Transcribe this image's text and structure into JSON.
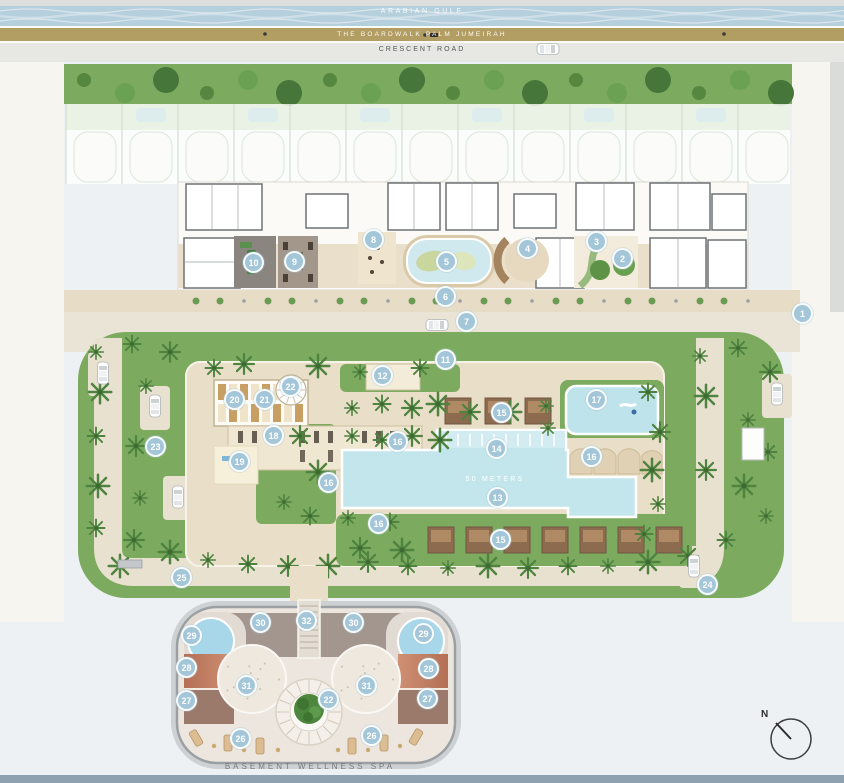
{
  "bands": {
    "top_water_label": "ARABIAN GULF",
    "boardwalk_label": "THE BOARDWALK PALM JUMEIRAH",
    "road_label": "CRESCENT ROAD"
  },
  "plan": {
    "pool_length_label": "50 METERS",
    "spa_label": "BASEMENT WELLNESS SPA",
    "compass_label": "N"
  },
  "colors": {
    "water": "#b5cfdd",
    "boardwalk": "#b29d62",
    "road": "#e7e8e3",
    "grass": "#7cab5f",
    "deck": "#e9dfc8",
    "pool": "#c3e6ec",
    "marker": "#a3c6d8",
    "spa_floor": "#ece6de",
    "terracotta": "#c5826a",
    "bottom_bar": "#8da1b1"
  },
  "markers": [
    {
      "n": 1,
      "x": 803,
      "y": 314
    },
    {
      "n": 2,
      "x": 623,
      "y": 259
    },
    {
      "n": 3,
      "x": 597,
      "y": 242
    },
    {
      "n": 4,
      "x": 528,
      "y": 249
    },
    {
      "n": 5,
      "x": 447,
      "y": 262
    },
    {
      "n": 6,
      "x": 446,
      "y": 297
    },
    {
      "n": 7,
      "x": 467,
      "y": 322
    },
    {
      "n": 8,
      "x": 374,
      "y": 240
    },
    {
      "n": 9,
      "x": 295,
      "y": 262
    },
    {
      "n": 10,
      "x": 254,
      "y": 263
    },
    {
      "n": 11,
      "x": 446,
      "y": 360
    },
    {
      "n": 12,
      "x": 383,
      "y": 376
    },
    {
      "n": 13,
      "x": 498,
      "y": 498
    },
    {
      "n": 14,
      "x": 497,
      "y": 449
    },
    {
      "n": 15,
      "x": 502,
      "y": 413
    },
    {
      "n": 15,
      "x": 501,
      "y": 540
    },
    {
      "n": 16,
      "x": 398,
      "y": 442
    },
    {
      "n": 16,
      "x": 329,
      "y": 483
    },
    {
      "n": 16,
      "x": 379,
      "y": 524
    },
    {
      "n": 16,
      "x": 592,
      "y": 457
    },
    {
      "n": 17,
      "x": 597,
      "y": 400
    },
    {
      "n": 18,
      "x": 274,
      "y": 436
    },
    {
      "n": 19,
      "x": 240,
      "y": 462
    },
    {
      "n": 20,
      "x": 235,
      "y": 400
    },
    {
      "n": 21,
      "x": 265,
      "y": 400
    },
    {
      "n": 22,
      "x": 291,
      "y": 387
    },
    {
      "n": 22,
      "x": 329,
      "y": 700
    },
    {
      "n": 23,
      "x": 156,
      "y": 447
    },
    {
      "n": 24,
      "x": 708,
      "y": 585
    },
    {
      "n": 25,
      "x": 182,
      "y": 578
    },
    {
      "n": 26,
      "x": 241,
      "y": 739
    },
    {
      "n": 26,
      "x": 372,
      "y": 736
    },
    {
      "n": 27,
      "x": 187,
      "y": 701
    },
    {
      "n": 27,
      "x": 428,
      "y": 699
    },
    {
      "n": 28,
      "x": 187,
      "y": 668
    },
    {
      "n": 28,
      "x": 429,
      "y": 669
    },
    {
      "n": 29,
      "x": 192,
      "y": 636
    },
    {
      "n": 29,
      "x": 424,
      "y": 634
    },
    {
      "n": 30,
      "x": 261,
      "y": 623
    },
    {
      "n": 30,
      "x": 354,
      "y": 623
    },
    {
      "n": 31,
      "x": 247,
      "y": 686
    },
    {
      "n": 31,
      "x": 367,
      "y": 686
    },
    {
      "n": 32,
      "x": 307,
      "y": 621
    }
  ]
}
